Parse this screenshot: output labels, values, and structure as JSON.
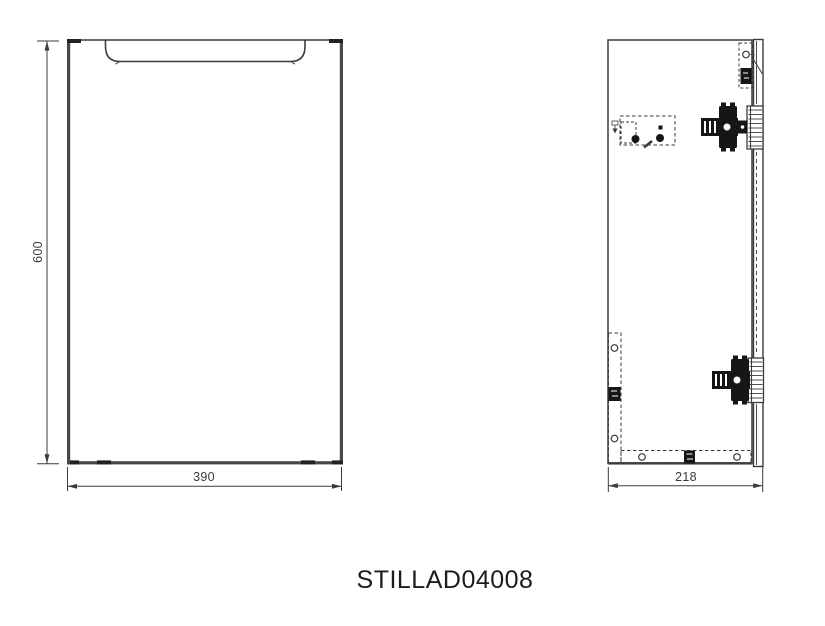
{
  "title": {
    "part_number": "STILLAD04008"
  },
  "front_view": {
    "height_dim": "600",
    "width_dim": "390"
  },
  "side_view": {
    "depth_dim": "218"
  },
  "colors": {
    "line": "#3b3b3b",
    "thick_edge": "#474747",
    "hardware_fill": "#161616",
    "background": "#ffffff"
  }
}
